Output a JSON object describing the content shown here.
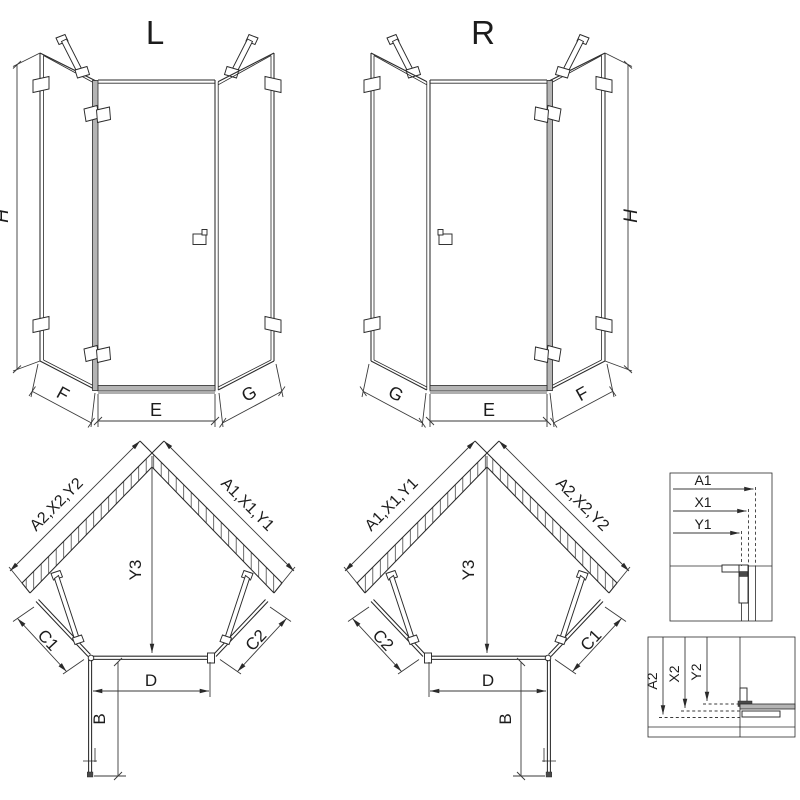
{
  "drawing_type": "shower-enclosure-technical-drawing",
  "palette": {
    "background": "#ffffff",
    "line": "#2a2a2a",
    "dim_line": "#3a3a3a",
    "profile_gray": "#b4b4b4",
    "profile_dark": "#4a4a4a",
    "text": "#1c1c1c"
  },
  "views": {
    "front_left": {
      "title": "L",
      "height_label": "H",
      "bottom_left_label": "F",
      "bottom_center_label": "E",
      "bottom_right_label": "G"
    },
    "front_right": {
      "title": "R",
      "height_label": "H",
      "bottom_left_label": "G",
      "bottom_center_label": "E",
      "bottom_right_label": "F"
    },
    "plan_left": {
      "wall_left_label": "A2,X2,Y2",
      "wall_right_label": "A1,X1,Y1",
      "depth_label": "Y3",
      "side_left_label": "C1",
      "side_right_label": "C2",
      "door_width_label": "D",
      "door_swing_label": "B"
    },
    "plan_right": {
      "wall_left_label": "A1,X1,Y1",
      "wall_right_label": "A2,X2,Y2",
      "depth_label": "Y3",
      "side_left_label": "C2",
      "side_right_label": "C1",
      "door_width_label": "D",
      "door_swing_label": "B"
    },
    "detail_top": {
      "dim1": "A1",
      "dim2": "X1",
      "dim3": "Y1"
    },
    "detail_bottom": {
      "dim1": "A2",
      "dim2": "X2",
      "dim3": "Y2"
    }
  }
}
